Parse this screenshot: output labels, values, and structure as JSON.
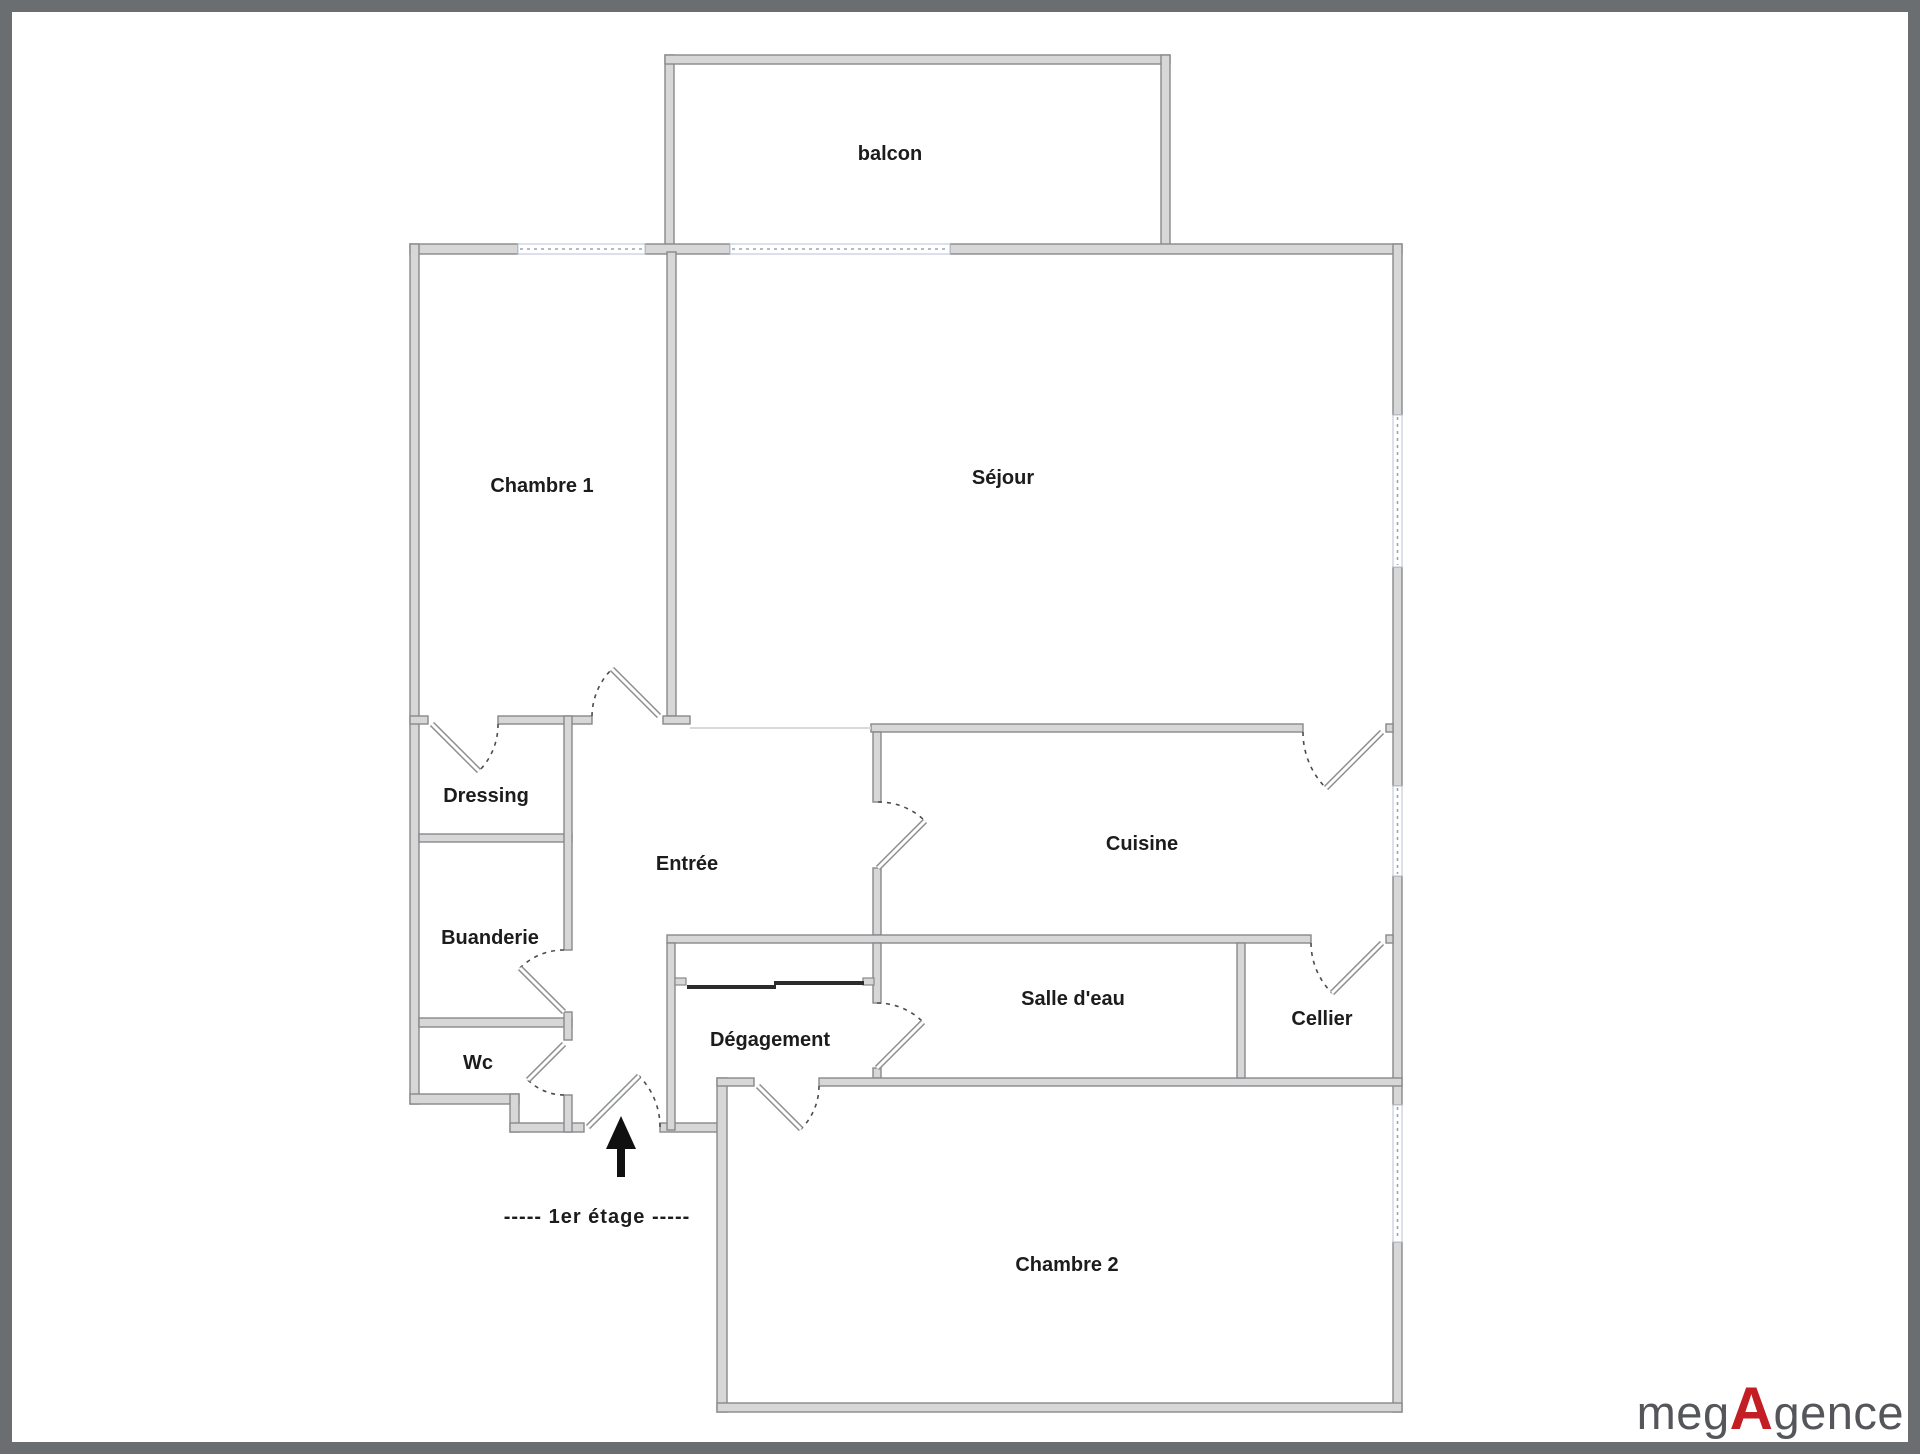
{
  "plan": {
    "rooms": {
      "balcon": "balcon",
      "chambre1": "Chambre 1",
      "sejour": "Séjour",
      "dressing": "Dressing",
      "entree": "Entrée",
      "cuisine": "Cuisine",
      "buanderie": "Buanderie",
      "salle_deau": "Salle d'eau",
      "cellier": "Cellier",
      "wc": "Wc",
      "degagement": "Dégagement",
      "chambre2": "Chambre 2"
    },
    "floor_label": "-----  1er étage  -----"
  },
  "logo": {
    "part1": "meg",
    "accent": "A",
    "part2": "gence"
  },
  "colors": {
    "frame_color": "#6b6e71",
    "wall_fill": "#d7d7d7",
    "wall_edge": "#87898c",
    "window_line": "#98a3ba",
    "arc_color": "#4b4b4b",
    "label_color": "#1c1c1c",
    "logo_text": "#55565a",
    "logo_accent": "#c41e25"
  }
}
